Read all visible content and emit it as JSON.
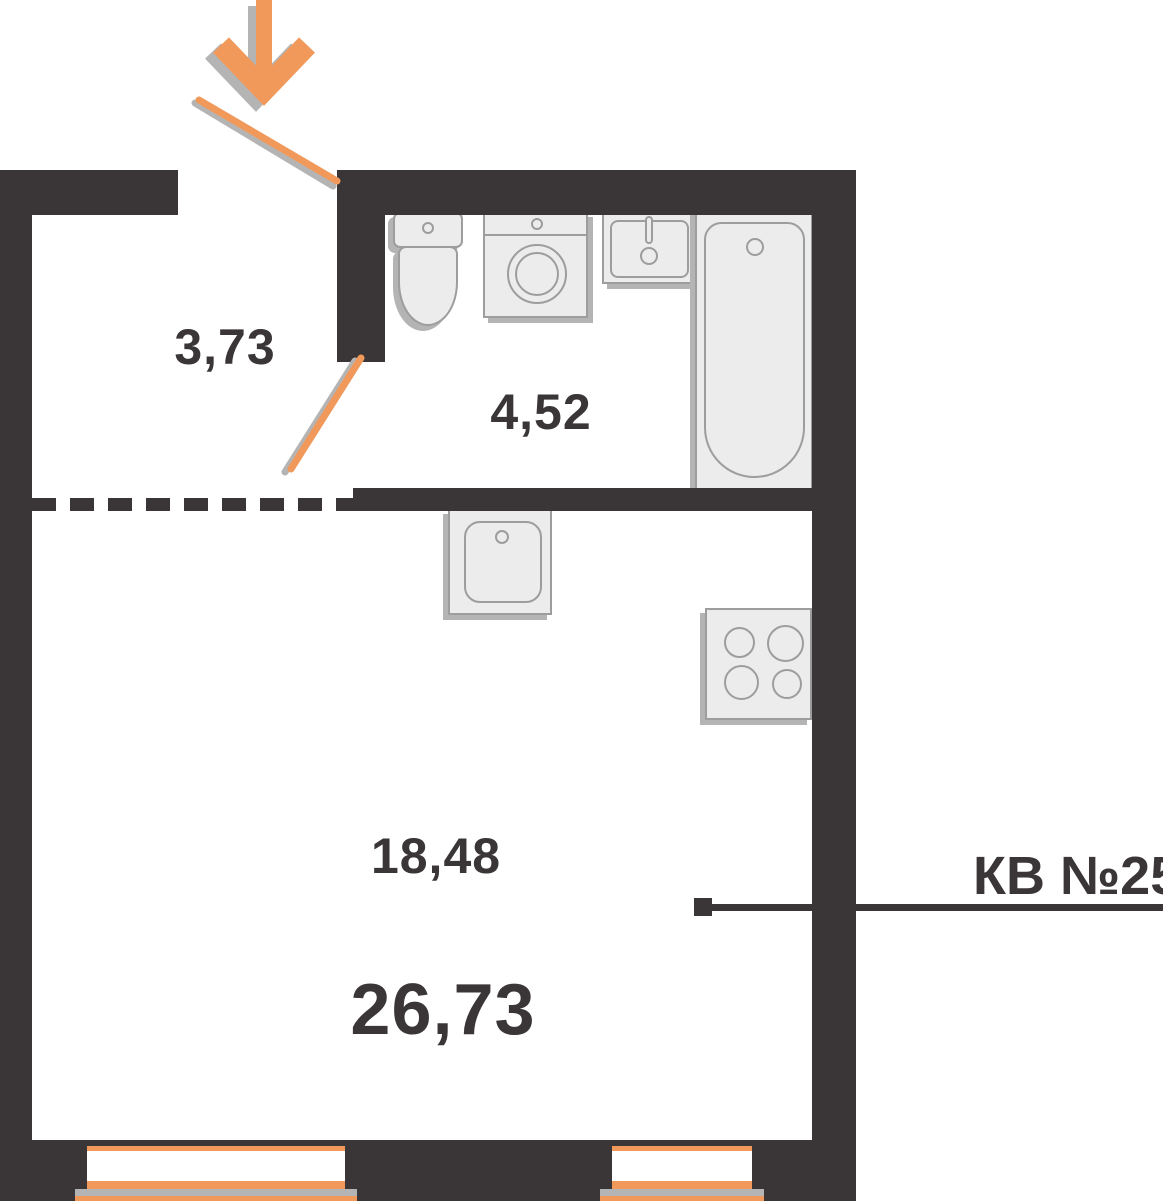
{
  "labels": {
    "hallway_area": "3,73",
    "bathroom_area": "4,52",
    "living_area": "18,48",
    "total_area": "26,73",
    "apartment": "КВ №25"
  },
  "colors": {
    "wall": "#3a3637",
    "accent": "#f0995b",
    "shadow": "#b5b4b4",
    "fixture_fill": "#ececec",
    "fixture_line": "#9d9d9d",
    "text": "#3a3637"
  },
  "icons": {
    "entrance": "down-arrow-icon",
    "doors": [
      "entrance-door-swing",
      "bathroom-door-swing"
    ],
    "fixtures": [
      "toilet",
      "washing-machine",
      "sink",
      "bathtub",
      "kitchen-sink",
      "stove"
    ],
    "windows": 2
  }
}
